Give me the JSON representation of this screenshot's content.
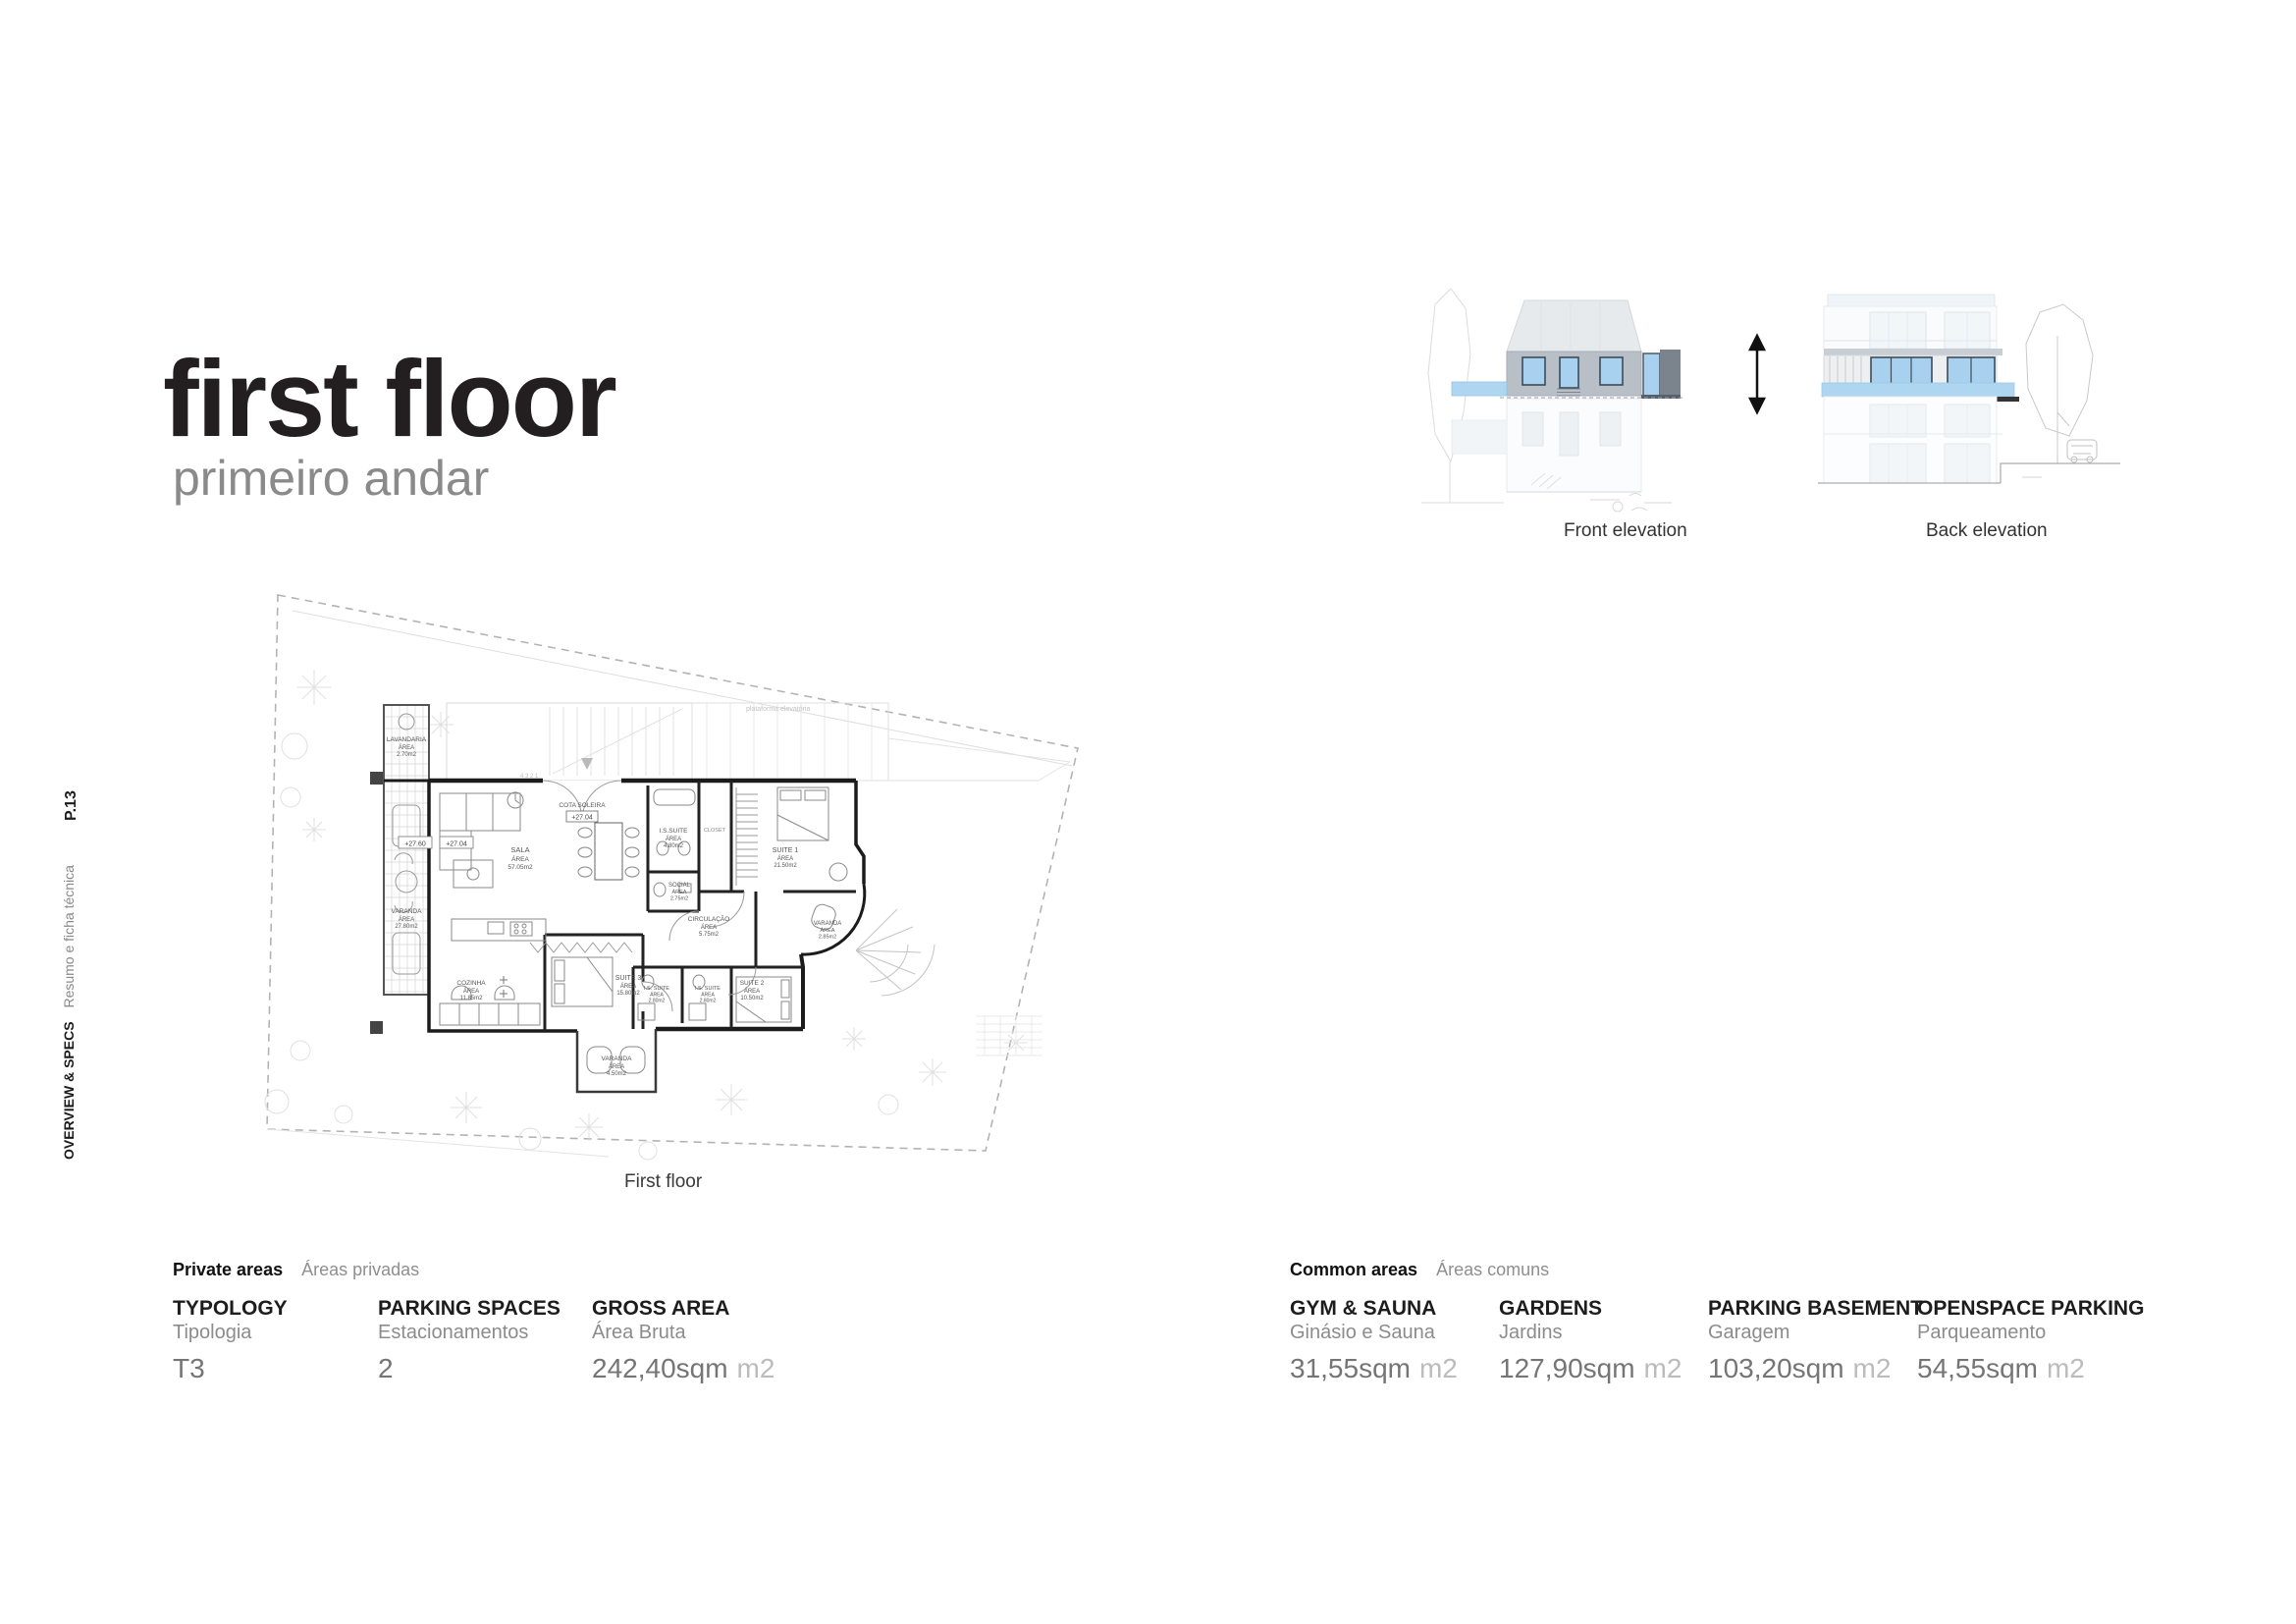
{
  "page": {
    "title": "first floor",
    "subtitle": "primeiro andar",
    "page_number": "P.13",
    "section_label_en": "OVERVIEW & SPECS",
    "section_label_pt": "Resumo e ficha técnica"
  },
  "elevations": {
    "front_label": "Front elevation",
    "back_label": "Back elevation"
  },
  "floor_plan": {
    "caption": "First floor",
    "platform_note": "plataforma elevatória",
    "closet_label": "CLOSET",
    "stair_numbers": "4  3  2  1",
    "threshold": {
      "line1": "COTA SOLEIRA",
      "value": "+27.04"
    },
    "level_tags": [
      "+27.60",
      "+27.04"
    ],
    "rooms": [
      {
        "name": "LAVANDARIA",
        "area_label": "ÁREA",
        "area": "2.70m2"
      },
      {
        "name": "VARANDA",
        "area_label": "ÁREA",
        "area": "27.80m2"
      },
      {
        "name": "SALA",
        "area_label": "ÁREA",
        "area": "57.05m2"
      },
      {
        "name": "I.S.SUITE",
        "area_label": "ÁREA",
        "area": "4.80m2"
      },
      {
        "name": "SOCIAL",
        "area_label": "ÁREA",
        "area": "2.75m2"
      },
      {
        "name": "CIRCULAÇÃO",
        "area_label": "ÁREA",
        "area": "5.75m2"
      },
      {
        "name": "COZINHA",
        "area_label": "ÁREA",
        "area": "11.85m2"
      },
      {
        "name": "SUITE 3",
        "area_label": "ÁREA",
        "area": "15.80m2"
      },
      {
        "name": "I.S. SUITE",
        "area_label": "ÁREA",
        "area": "2.80m2"
      },
      {
        "name": "I.S. SUITE",
        "area_label": "ÁREA",
        "area": "2.80m2"
      },
      {
        "name": "SUITE 1",
        "area_label": "ÁREA",
        "area": "21.50m2"
      },
      {
        "name": "VARANDA",
        "area_label": "ÁREA",
        "area": "2.85m2"
      },
      {
        "name": "SUITE 2",
        "area_label": "ÁREA",
        "area": "10.50m2"
      },
      {
        "name": "VARANDA",
        "area_label": "ÁREA",
        "area": "4.50m2"
      }
    ]
  },
  "specs": {
    "private": {
      "heading_en": "Private areas",
      "heading_pt": "Áreas privadas",
      "items": [
        {
          "label_en": "TYPOLOGY",
          "label_pt": "Tipologia",
          "value": "T3",
          "unit": ""
        },
        {
          "label_en": "PARKING SPACES",
          "label_pt": "Estacionamentos",
          "value": "2",
          "unit": ""
        },
        {
          "label_en": "GROSS AREA",
          "label_pt": "Área Bruta",
          "value": "242,40sqm",
          "unit": "m2"
        }
      ]
    },
    "common": {
      "heading_en": "Common areas",
      "heading_pt": "Áreas comuns",
      "items": [
        {
          "label_en": "GYM & SAUNA",
          "label_pt": "Ginásio e Sauna",
          "value": "31,55sqm",
          "unit": "m2"
        },
        {
          "label_en": "GARDENS",
          "label_pt": "Jardins",
          "value": "127,90sqm",
          "unit": "m2"
        },
        {
          "label_en": "PARKING BASEMENT",
          "label_pt": "Garagem",
          "value": "103,20sqm",
          "unit": "m2"
        },
        {
          "label_en": "OPENSPACE PARKING",
          "label_pt": "Parqueamento",
          "value": "54,55sqm",
          "unit": "m2"
        }
      ]
    }
  },
  "colors": {
    "accent_blue": "#a7d1ef",
    "balcony_blue": "#aed6f1",
    "highlight_gray": "#b8bfc6",
    "dark_block_gray": "#7b838c",
    "text_dark": "#231f20",
    "text_gray": "#8a8a8a",
    "text_light": "#bcbcbc"
  }
}
